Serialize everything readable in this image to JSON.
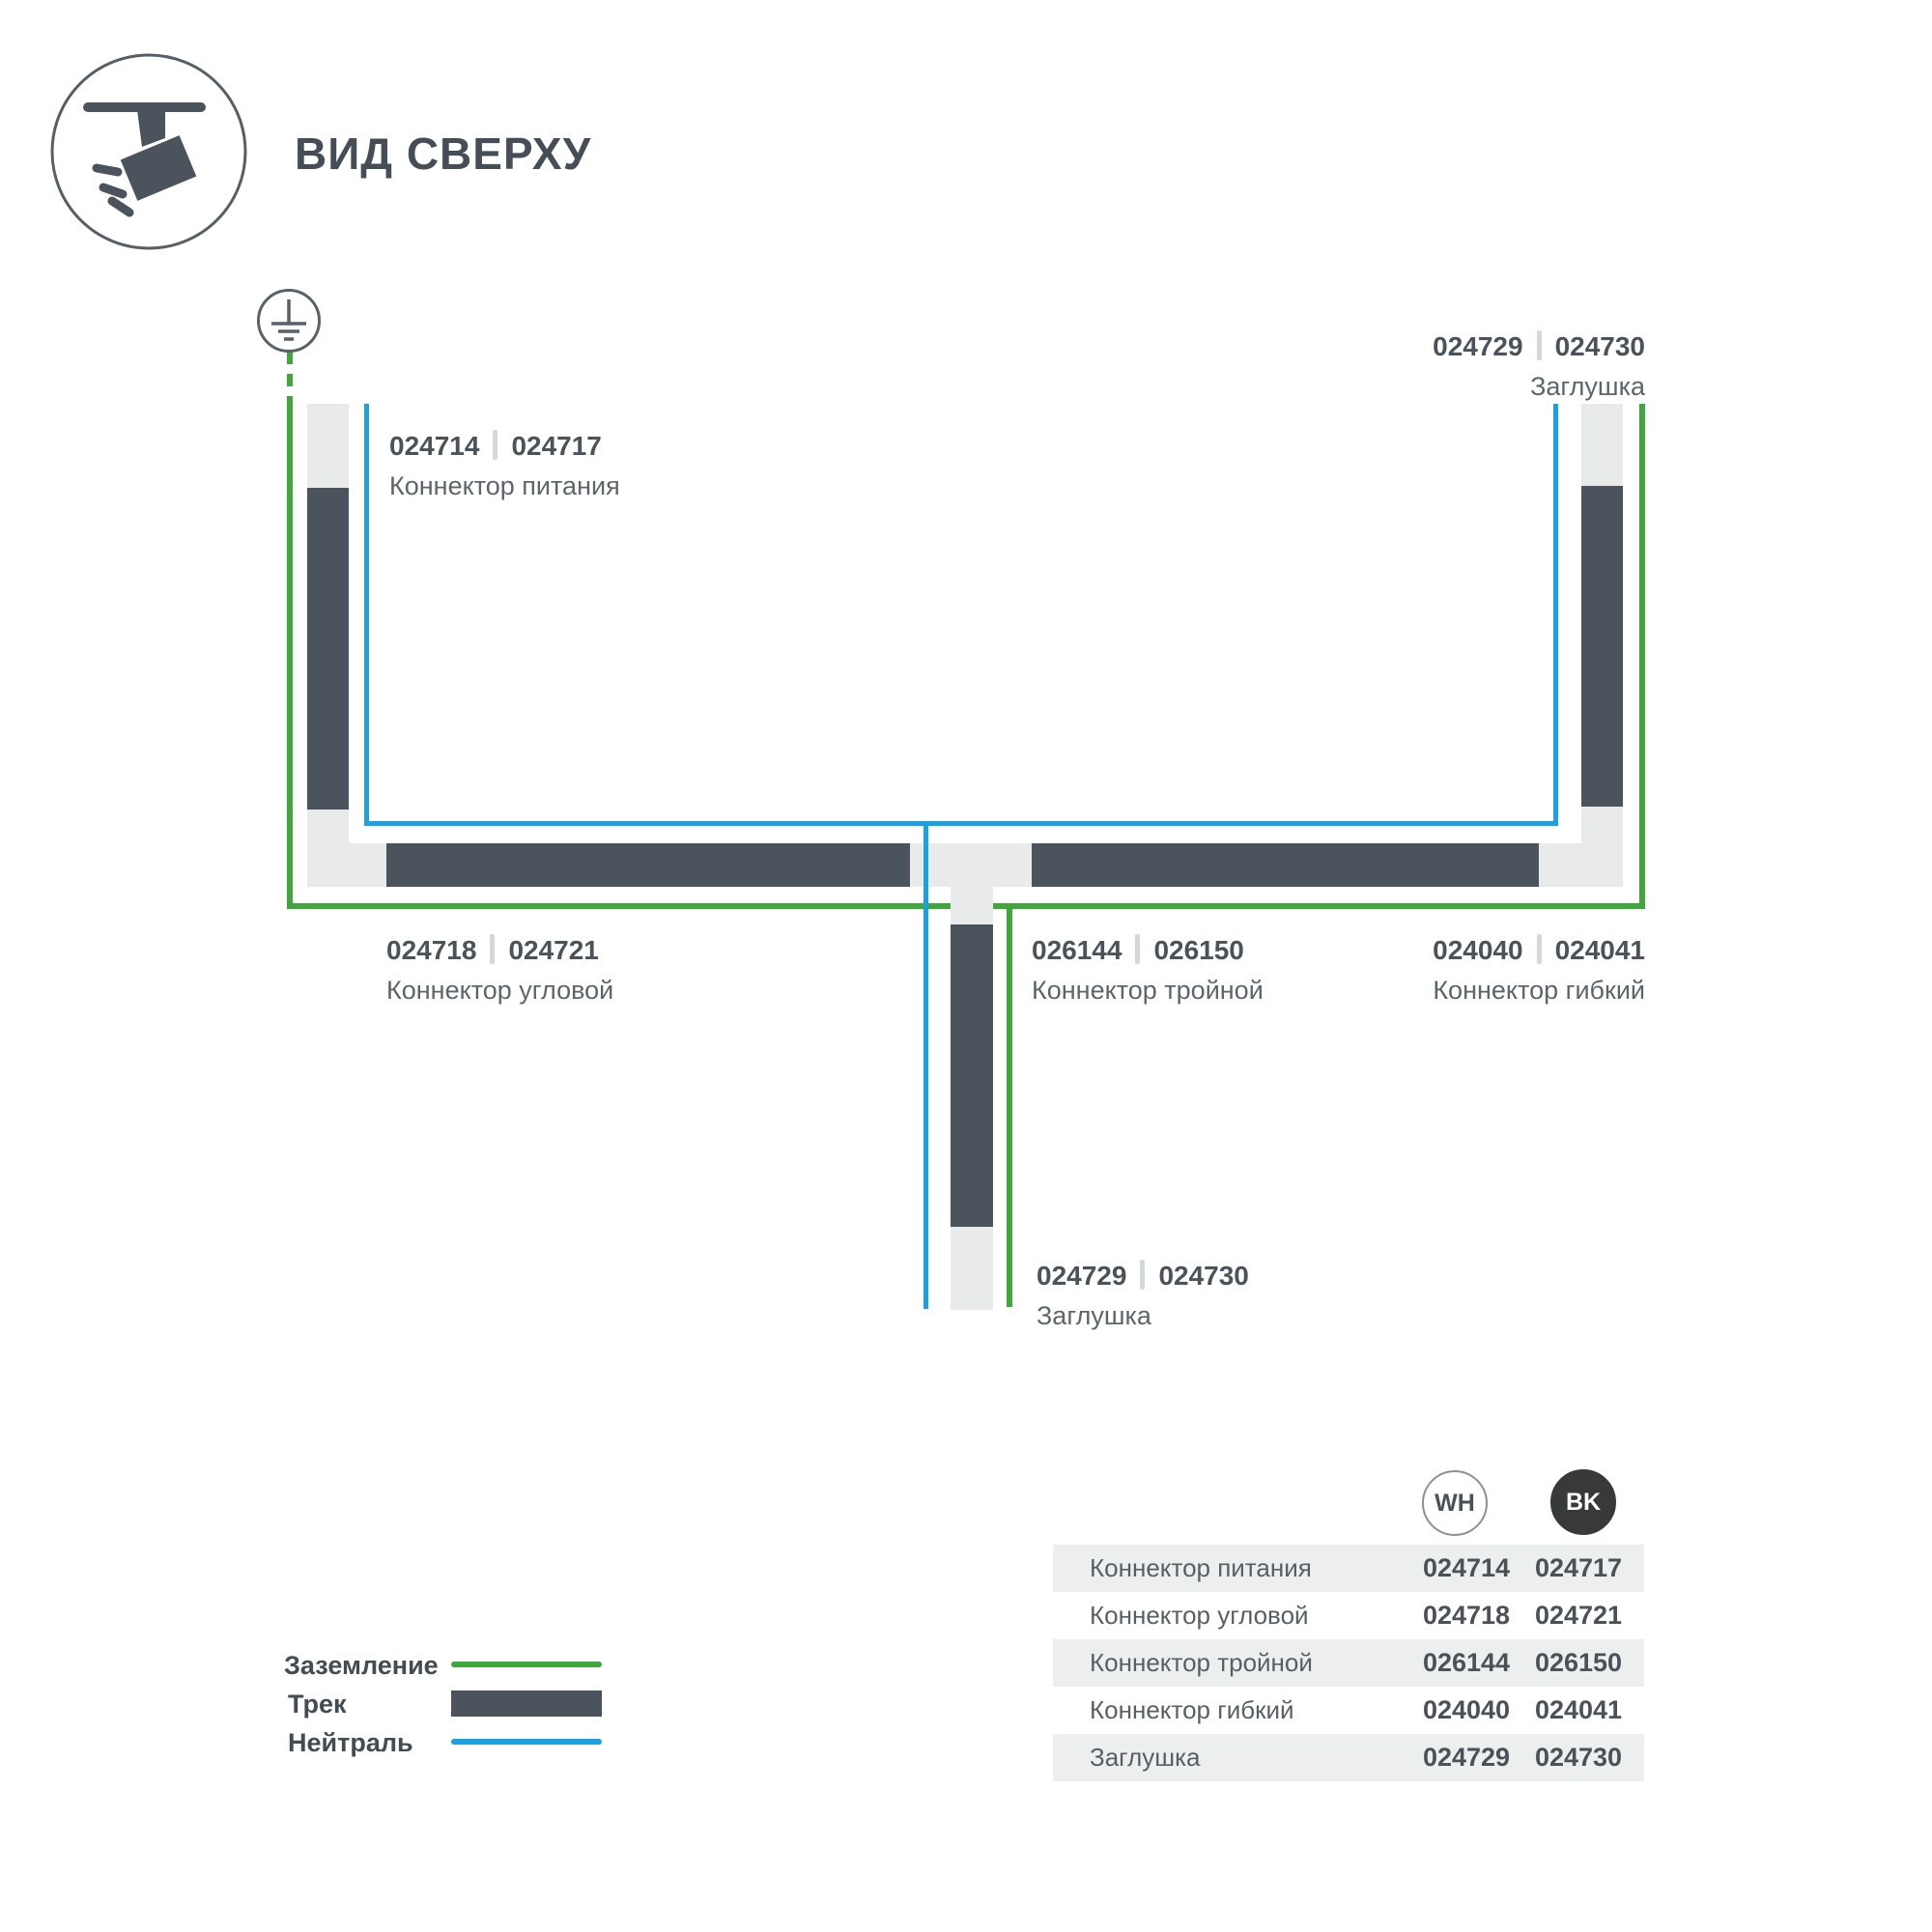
{
  "header": {
    "title": "ВИД СВЕРХУ"
  },
  "icons": {
    "header_icon": "track-spotlight-icon",
    "ground_icon": "earth-ground-icon"
  },
  "colors": {
    "track_dark": "#4b545c",
    "track_channel": "#e9ebeb",
    "ground_green": "#3fa83a",
    "neutral_blue": "#1ba1df",
    "text_dark": "#454e56",
    "text_gray": "#5d656c",
    "table_row_shade": "#edefef",
    "bk_circle": "#37393a"
  },
  "diagram": {
    "labels": [
      {
        "codes": [
          "024714",
          "024717"
        ],
        "name": "Коннектор питания"
      },
      {
        "codes": [
          "024729",
          "024730"
        ],
        "name": "Заглушка"
      },
      {
        "codes": [
          "024718",
          "024721"
        ],
        "name": "Коннектор угловой"
      },
      {
        "codes": [
          "026144",
          "026150"
        ],
        "name": "Коннектор тройной"
      },
      {
        "codes": [
          "024040",
          "024041"
        ],
        "name": "Коннектор гибкий"
      },
      {
        "codes": [
          "024729",
          "024730"
        ],
        "name": "Заглушка"
      }
    ]
  },
  "legend": {
    "items": [
      {
        "label": "Заземление",
        "swatch": "ground-line"
      },
      {
        "label": "Трек",
        "swatch": "track-bar"
      },
      {
        "label": "Нейтраль",
        "swatch": "neutral-line"
      }
    ]
  },
  "table": {
    "columns": [
      {
        "label": "WH"
      },
      {
        "label": "BK"
      }
    ],
    "rows": [
      {
        "name": "Коннектор питания",
        "wh": "024714",
        "bk": "024717"
      },
      {
        "name": "Коннектор угловой",
        "wh": "024718",
        "bk": "024721"
      },
      {
        "name": "Коннектор тройной",
        "wh": "026144",
        "bk": "026150"
      },
      {
        "name": "Коннектор гибкий",
        "wh": "024040",
        "bk": "024041"
      },
      {
        "name": "Заглушка",
        "wh": "024729",
        "bk": "024730"
      }
    ]
  }
}
